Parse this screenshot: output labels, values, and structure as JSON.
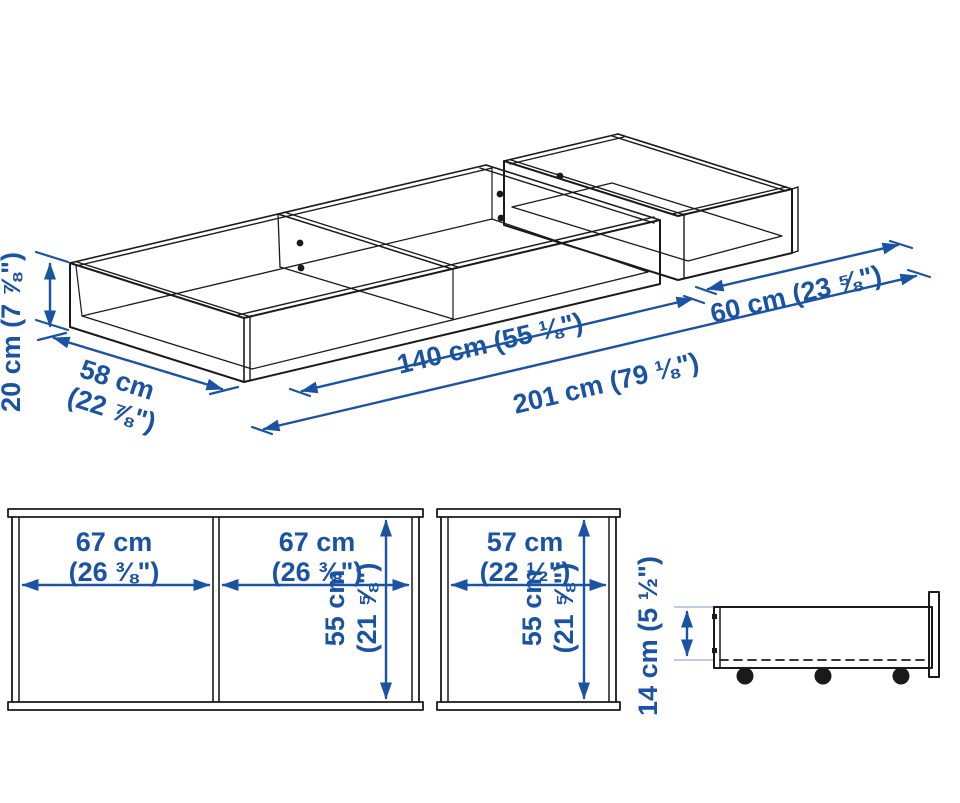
{
  "diagram_title": "Under-bed storage box dimension drawing",
  "colors": {
    "dimension_blue": "#1A52A4",
    "line_black": "#1a1a1a",
    "extension_gray": "#A8BBD8",
    "background": "#ffffff"
  },
  "iso": {
    "height": "20 cm (7 ⅞\")",
    "depth_cm": "58 cm",
    "depth_in": "(22 ⅞\")",
    "length_large": "140 cm (55 ⅛\")",
    "length_total": "201 cm (79 ⅛\")",
    "length_small": "60 cm (23 ⅝\")"
  },
  "plan_large": {
    "left_cm": "67 cm",
    "left_in": "(26 ⅜\")",
    "right_cm": "67 cm",
    "right_in": "(26 ⅜\")",
    "depth_cm": "55 cm",
    "depth_in": "(21 ⅝\")"
  },
  "plan_small": {
    "width_cm": "57 cm",
    "width_in": "(22 ½\")",
    "depth_cm": "55 cm",
    "depth_in": "(21 ⅝\")"
  },
  "side": {
    "height": "14 cm (5 ½\")"
  }
}
